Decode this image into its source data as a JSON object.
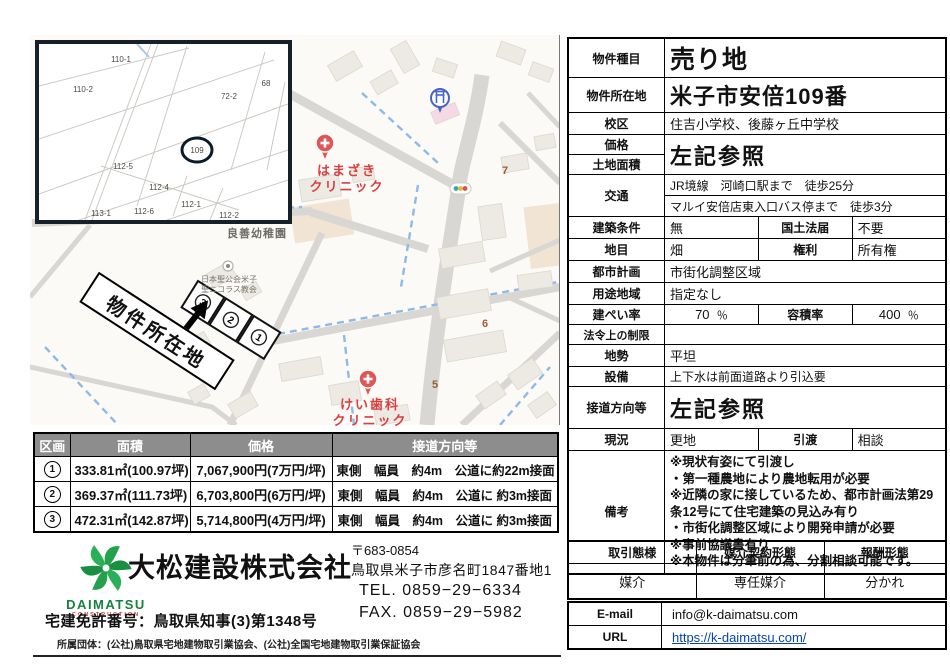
{
  "map": {
    "site_label": "物件所在地",
    "lot_marks": {
      "l3": "3",
      "l2": "2",
      "l1": "1"
    },
    "pois": {
      "hamazaki1": "はまざき",
      "hamazaki2": "クリニック",
      "kei1": "けい歯科",
      "kei2": "クリニック",
      "kindergarten": "良善幼稚園",
      "church1": "日本聖公会米子",
      "church2": "聖ニコラス教会"
    },
    "route_labels": {
      "r7": "7",
      "r6": "6",
      "r5": "5"
    },
    "inset_parcels": {
      "p110_1": "110-1",
      "p110_2": "110-2",
      "p72_2": "72-2",
      "p68": "68",
      "p109": "109",
      "p112_5": "112-5",
      "p112_4": "112-4",
      "p112_1": "112-1",
      "p113_1": "113-1",
      "p112_6": "112-6",
      "p112_2": "112-2"
    }
  },
  "lots": {
    "headers": [
      "区画",
      "面積",
      "価格",
      "接道方向等"
    ],
    "rows": [
      {
        "no": "1",
        "area": "333.81㎡(100.97坪)",
        "price": "7,067,900円(7万円/坪)",
        "road": "東側　幅員　約4m　公道に約22m接面"
      },
      {
        "no": "2",
        "area": "369.37㎡(111.73坪)",
        "price": "6,703,800円(6万円/坪)",
        "road": "東側　幅員　約4m　公道に 約3m接面"
      },
      {
        "no": "3",
        "area": "472.31㎡(142.87坪)",
        "price": "5,714,800円(4万円/坪)",
        "road": "東側　幅員　約4m　公道に 約3m接面"
      }
    ]
  },
  "spec": {
    "type_label": "物件種目",
    "type_value": "売り地",
    "location_label": "物件所在地",
    "location_value": "米子市安倍109番",
    "school_label": "校区",
    "school_value": "住吉小学校、後藤ヶ丘中学校",
    "price_label": "価格",
    "land_area_label": "土地面積",
    "price_value": "左記参照",
    "transport_label": "交通",
    "transport_line1": "JR境線　河崎口駅まで　徒歩25分",
    "transport_line2": "マルイ安倍店東入口バス停まで　徒歩3分",
    "building_cond_label": "建築条件",
    "building_cond_value": "無",
    "national_land_label": "国土法届",
    "national_land_value": "不要",
    "land_cat_label": "地目",
    "land_cat_value": "畑",
    "rights_label": "権利",
    "rights_value": "所有権",
    "city_plan_label": "都市計画",
    "city_plan_value": "市街化調整区域",
    "use_district_label": "用途地域",
    "use_district_value": "指定なし",
    "bcr_label": "建ぺい率",
    "bcr_value": "70",
    "bcr_unit": "％",
    "far_label": "容積率",
    "far_value": "400",
    "far_unit": "％",
    "legal_label": "法令上の制限",
    "legal_value": "",
    "terrain_label": "地勢",
    "terrain_value": "平坦",
    "utilities_label": "設備",
    "utilities_value": "上下水は前面道路より引込要",
    "road_dir_label": "接道方向等",
    "road_dir_value": "左記参照",
    "current_label": "現況",
    "current_value": "更地",
    "handover_label": "引渡",
    "handover_value": "相談",
    "remarks_label": "備考",
    "remarks": [
      "※現状有姿にて引渡し",
      "・第一種農地により農地転用が必要",
      "※近隣の家に接しているため、都市計画法第29条12号にて住宅建築の見込み有り",
      "・市街化調整区域により開発申請が必要",
      "※事前協議書有り",
      "※本物件は分筆前の為、分割相談可能です。"
    ]
  },
  "company": {
    "logo_name": "DAIMATSU",
    "logo_sub": "CONSTRUCTION",
    "name": "大松建設株式会社",
    "zip": "〒683-0854",
    "address": "鳥取県米子市彦名町1847番地1",
    "tel": "TEL. 0859−29−6334",
    "fax": "FAX. 0859−29−5982",
    "license": "宅建免許番号：鳥取県知事(3)第1348号",
    "associations": "所属団体：(公社)鳥取県宅地建物取引業協会、(公社)全国宅地建物取引業保証協会"
  },
  "deal": {
    "h1": "取引態様",
    "h2": "媒介契約形態",
    "h3": "報酬形態",
    "v1": "媒介",
    "v2": "専任媒介",
    "v3": "分かれ"
  },
  "contact": {
    "email_label": "E-mail",
    "email_value": "info@k-daimatsu.com",
    "url_label": "URL",
    "url_value": "https://k-daimatsu.com/"
  },
  "colors": {
    "lot_header_bg": "#8d8d8d",
    "poi_red": "#d84040",
    "link_blue": "#0645ad",
    "logo_green": "#1f9d4b",
    "water_blue": "#8fb9e6",
    "road_gray": "#d8d7d3"
  }
}
